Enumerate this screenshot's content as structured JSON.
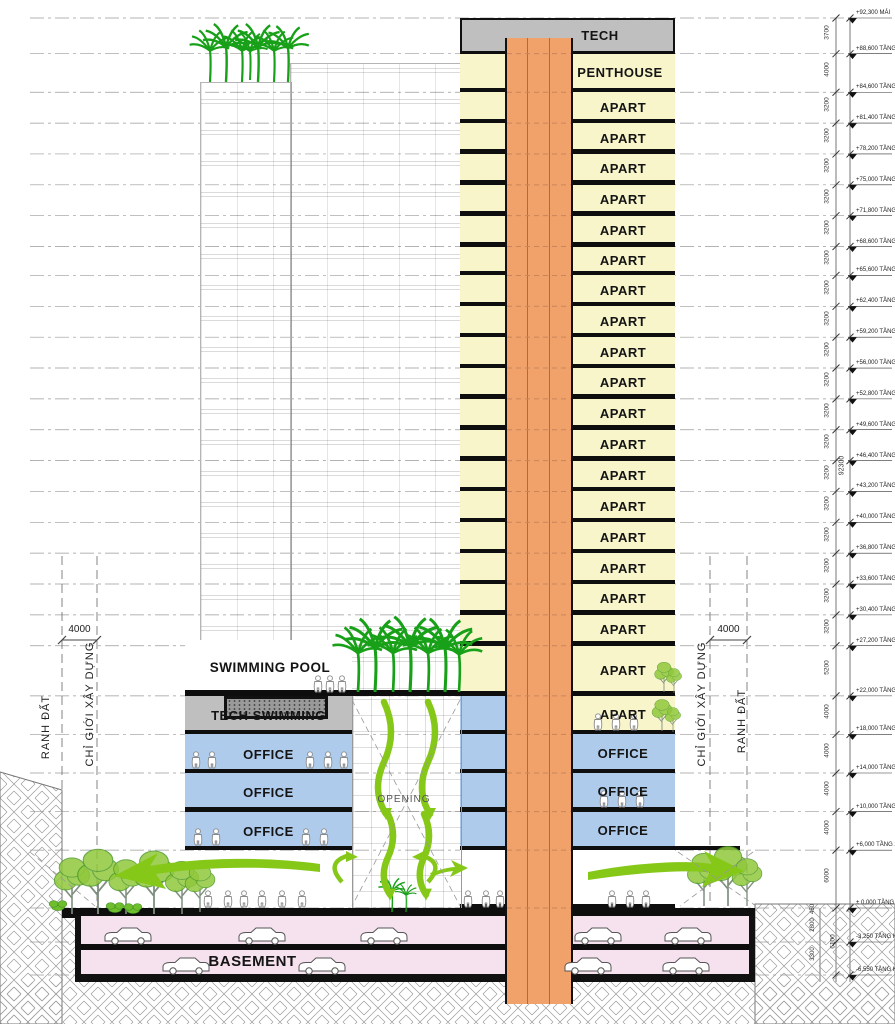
{
  "colors": {
    "apart": "#F8F5CB",
    "core": "#F1A26B",
    "office": "#AFCBEB",
    "tech": "#BFBFBF",
    "basement": "#F5E2EE",
    "greenery": "#18A018",
    "foliage": "#90C83C",
    "arrow": "#86C818",
    "slab": "#0E0E0E"
  },
  "boundary_left": {
    "dim": "4000",
    "outer": "RANH ĐẤT",
    "inner": "CHỈ GIỚI XÂY DỰNG"
  },
  "boundary_right": {
    "dim": "4000",
    "inner": "CHỈ GIỚI XÂY DỰNG",
    "outer": "RANH ĐẤT"
  },
  "totals": {
    "overall": "92300",
    "basement": "6100"
  },
  "levels": [
    {
      "elev": 92300,
      "label": "+92,300 MÁI"
    },
    {
      "elev": 88600,
      "label": "+88,600 TẦNG KỸ 1"
    },
    {
      "elev": 84600,
      "label": "+84,600 TẦNG 25"
    },
    {
      "elev": 81400,
      "label": "+81,400 TẦNG 24"
    },
    {
      "elev": 78200,
      "label": "+78,200 TẦNG 23"
    },
    {
      "elev": 75000,
      "label": "+75,000 TẦNG 22"
    },
    {
      "elev": 71800,
      "label": "+71,800 TẦNG 21"
    },
    {
      "elev": 68600,
      "label": "+68,600 TẦNG 20"
    },
    {
      "elev": 65600,
      "label": "+65,600 TẦNG 19"
    },
    {
      "elev": 62400,
      "label": "+62,400 TẦNG 18"
    },
    {
      "elev": 59200,
      "label": "+59,200 TẦNG 17"
    },
    {
      "elev": 56000,
      "label": "+56,000 TẦNG 16"
    },
    {
      "elev": 52800,
      "label": "+52,800 TẦNG 15"
    },
    {
      "elev": 49600,
      "label": "+49,600 TẦNG 14"
    },
    {
      "elev": 46400,
      "label": "+46,400 TẦNG 13"
    },
    {
      "elev": 43200,
      "label": "+43,200 TẦNG 12"
    },
    {
      "elev": 40000,
      "label": "+40,000 TẦNG 11"
    },
    {
      "elev": 36800,
      "label": "+36,800 TẦNG 10"
    },
    {
      "elev": 33600,
      "label": "+33,600 TẦNG 9"
    },
    {
      "elev": 30400,
      "label": "+30,400 TẦNG 8"
    },
    {
      "elev": 27200,
      "label": "+27,200 TẦNG 7"
    },
    {
      "elev": 22000,
      "label": "+22,000 TẦNG 6"
    },
    {
      "elev": 18000,
      "label": "+18,000 TẦNG 5"
    },
    {
      "elev": 14000,
      "label": "+14,000 TẦNG 4"
    },
    {
      "elev": 10000,
      "label": "+10,000 TẦNG 3"
    },
    {
      "elev": 6000,
      "label": "+6,000 TẦNG 2"
    },
    {
      "elev": 0,
      "label": "± 0,000 TẦNG 1"
    },
    {
      "elev": -3250,
      "label": "-3,250 TẦNG HẦM 1",
      "y": 942
    },
    {
      "elev": -6550,
      "label": "-6,550 TẦNG HẦM 2",
      "y": 975
    }
  ],
  "dims": [
    "3700",
    "4000",
    "3200",
    "3200",
    "3200",
    "3200",
    "3200",
    "3200",
    "3200",
    "3200",
    "3200",
    "3200",
    "3200",
    "3200",
    "3200",
    "3200",
    "3200",
    "3200",
    "3200",
    "3200",
    "5200",
    "4000",
    "4000",
    "4000",
    "4000",
    "6000"
  ],
  "basement_dims": [
    "450",
    "2800",
    "3300"
  ],
  "tower": {
    "bands": [
      {
        "label": "TECH",
        "kind": "tech",
        "top": 92300,
        "bottom": 88600
      },
      {
        "label": "PENTHOUSE",
        "kind": "apart",
        "top": 88600,
        "bottom": 84600
      },
      {
        "label": "APART",
        "kind": "apart",
        "top": 84600,
        "bottom": 81400
      },
      {
        "label": "APART",
        "kind": "apart",
        "top": 81400,
        "bottom": 78200
      },
      {
        "label": "APART",
        "kind": "apart",
        "top": 78200,
        "bottom": 75000
      },
      {
        "label": "APART",
        "kind": "apart",
        "top": 75000,
        "bottom": 71800
      },
      {
        "label": "APART",
        "kind": "apart",
        "top": 71800,
        "bottom": 68600
      },
      {
        "label": "APART",
        "kind": "apart",
        "top": 68600,
        "bottom": 65600
      },
      {
        "label": "APART",
        "kind": "apart",
        "top": 65600,
        "bottom": 62400
      },
      {
        "label": "APART",
        "kind": "apart",
        "top": 62400,
        "bottom": 59200
      },
      {
        "label": "APART",
        "kind": "apart",
        "top": 59200,
        "bottom": 56000
      },
      {
        "label": "APART",
        "kind": "apart",
        "top": 56000,
        "bottom": 52800
      },
      {
        "label": "APART",
        "kind": "apart",
        "top": 52800,
        "bottom": 49600
      },
      {
        "label": "APART",
        "kind": "apart",
        "top": 49600,
        "bottom": 46400
      },
      {
        "label": "APART",
        "kind": "apart",
        "top": 46400,
        "bottom": 43200
      },
      {
        "label": "APART",
        "kind": "apart",
        "top": 43200,
        "bottom": 40000
      },
      {
        "label": "APART",
        "kind": "apart",
        "top": 40000,
        "bottom": 36800
      },
      {
        "label": "APART",
        "kind": "apart",
        "top": 36800,
        "bottom": 33600
      },
      {
        "label": "APART",
        "kind": "apart",
        "top": 33600,
        "bottom": 30400
      },
      {
        "label": "APART",
        "kind": "apart",
        "top": 30400,
        "bottom": 27200
      },
      {
        "label": "APART",
        "kind": "apart",
        "top": 27200,
        "bottom": 22000
      },
      {
        "label": "APART",
        "kind": "apart",
        "top": 22000,
        "bottom": 18000,
        "left_blue": true
      },
      {
        "label": "OFFICE",
        "kind": "office",
        "top": 18000,
        "bottom": 14000,
        "left_blue": true
      },
      {
        "label": "OFFICE",
        "kind": "office",
        "top": 14000,
        "bottom": 10000,
        "left_blue": true
      },
      {
        "label": "OFFICE",
        "kind": "office",
        "top": 10000,
        "bottom": 6000,
        "left_blue": true
      },
      {
        "label": "",
        "kind": "lobby",
        "top": 6000,
        "bottom": 0
      }
    ]
  },
  "podium": {
    "roof_label": "SWIMMING POOL",
    "floors": [
      {
        "label": "TECH SWIMMING",
        "kind": "tech",
        "top": 22000,
        "bottom": 18000
      },
      {
        "label": "OFFICE",
        "kind": "office",
        "top": 18000,
        "bottom": 14000
      },
      {
        "label": "OFFICE",
        "kind": "office",
        "top": 14000,
        "bottom": 10000
      },
      {
        "label": "OFFICE",
        "kind": "office",
        "top": 10000,
        "bottom": 6000
      }
    ]
  },
  "atrium": {
    "label": "OPENING"
  },
  "basement": {
    "label": "BASEMENT"
  }
}
